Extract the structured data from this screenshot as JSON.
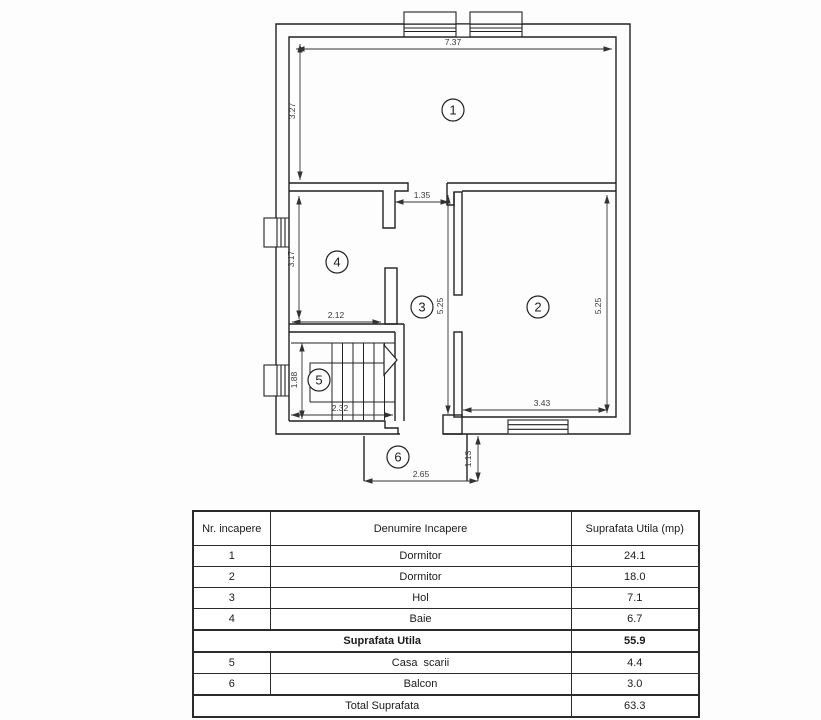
{
  "plan": {
    "markers": [
      "1",
      "2",
      "3",
      "4",
      "5",
      "6"
    ],
    "dims": {
      "room1_width": "7.37",
      "room1_height": "3.27",
      "hol_door_width": "1.35",
      "room4_height": "3.17",
      "room4_width": "2.12",
      "hol_height": "5.25",
      "room2_height": "5.25",
      "room2_width": "3.43",
      "stairs_height": "1.88",
      "stairs_width": "2.32",
      "balcony_width": "2.65",
      "balcony_depth": "1.13"
    }
  },
  "table": {
    "headers": [
      "Nr. incapere",
      "Denumire Incapere",
      "Suprafata Utila (mp)"
    ],
    "rows": [
      [
        "1",
        "Dormitor",
        "24.1"
      ],
      [
        "2",
        "Dormitor",
        "18.0"
      ],
      [
        "3",
        "Hol",
        "7.1"
      ],
      [
        "4",
        "Baie",
        "6.7"
      ]
    ],
    "subtotal": {
      "label": "Suprafata Utila",
      "value": "55.9"
    },
    "rows2": [
      [
        "5",
        "Casa  scarii",
        "4.4"
      ],
      [
        "6",
        "Balcon",
        "3.0"
      ]
    ],
    "total": {
      "label": "Total Suprafata",
      "value": "63.3"
    }
  }
}
